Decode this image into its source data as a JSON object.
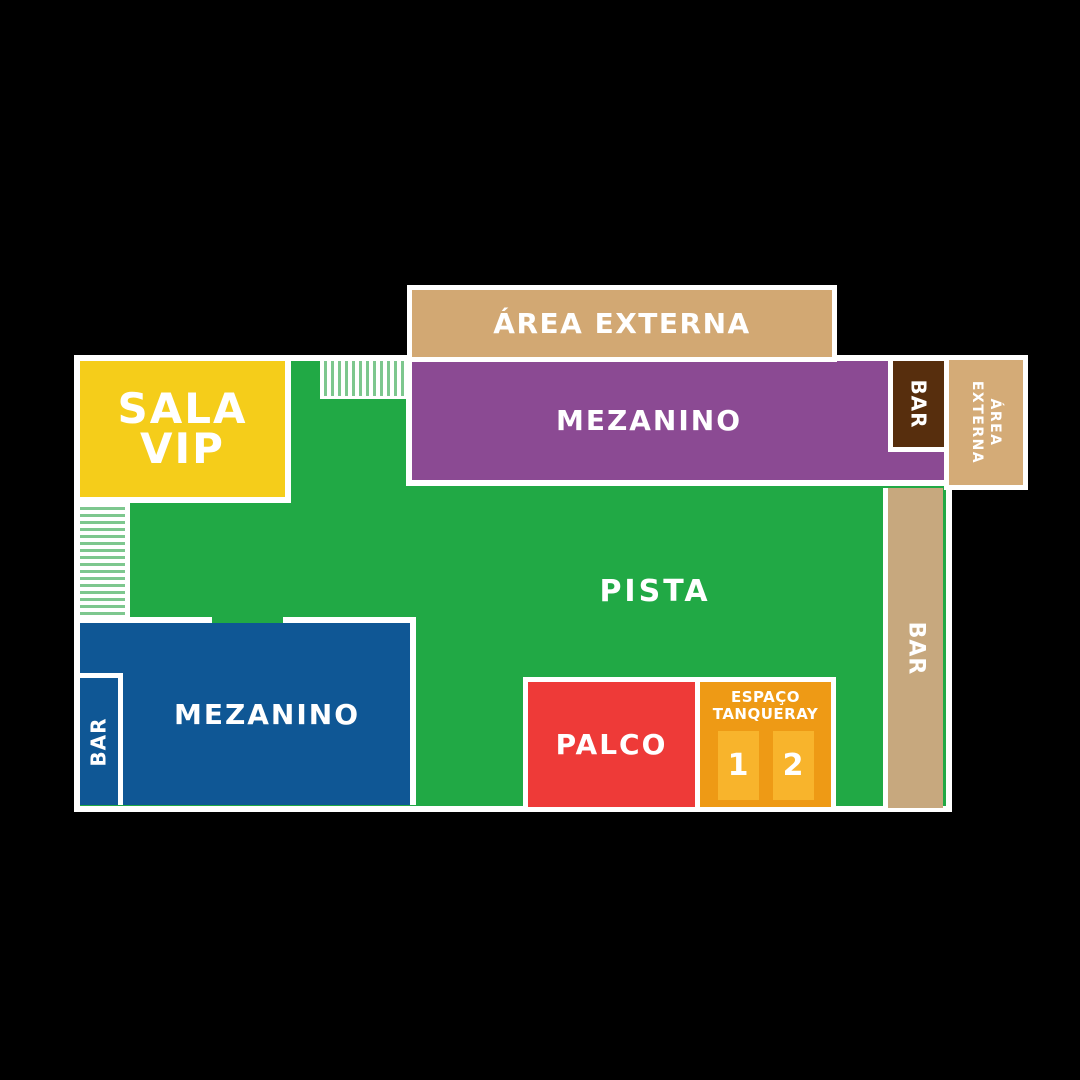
{
  "page": {
    "background": "#000000",
    "outline_color": "#ffffff",
    "description_colors": {
      "pista_green": "#21a945",
      "mezanino_purple": "#8b4a93",
      "mezanino_blue": "#0f5795",
      "sala_vip_yellow": "#f5cd1a",
      "palco_red": "#ee3a38",
      "espaco_orange": "#ee9a15",
      "booth_orange_light": "#f8b42c",
      "area_externa_tan": "#d2a873",
      "bar_tan": "#c7a87e",
      "bar_brown": "#572e0d",
      "stairs_stripe_green": "#7dc78e"
    }
  },
  "areas": {
    "area_externa_top": {
      "label": "ÁREA EXTERNA",
      "color": "#d2a873"
    },
    "mezanino_top": {
      "label": "MEZANINO",
      "color": "#8b4a93"
    },
    "bar_annex": {
      "label": "BAR",
      "color": "#572e0d"
    },
    "area_externa_right": {
      "line1": "ÁREA",
      "line2": "EXTERNA",
      "color": "#d4ab77"
    },
    "sala_vip": {
      "line1": "SALA",
      "line2": "VIP",
      "color": "#f5cd1a"
    },
    "pista": {
      "label": "PISTA",
      "color": "#21a945"
    },
    "bar_right": {
      "label": "BAR",
      "color": "#c7a87e"
    },
    "mezanino_bottom": {
      "label": "MEZANINO",
      "color": "#0f5795"
    },
    "bar_mezanino": {
      "label": "BAR",
      "color": "#0f5795"
    },
    "palco": {
      "label": "PALCO",
      "color": "#ee3a38"
    },
    "espaco_tanqueray": {
      "line1": "ESPAÇO",
      "line2": "TANQUERAY",
      "color": "#ee9a15",
      "booth_color": "#f8b42c",
      "booths": [
        {
          "number": "1"
        },
        {
          "number": "2"
        }
      ]
    }
  }
}
